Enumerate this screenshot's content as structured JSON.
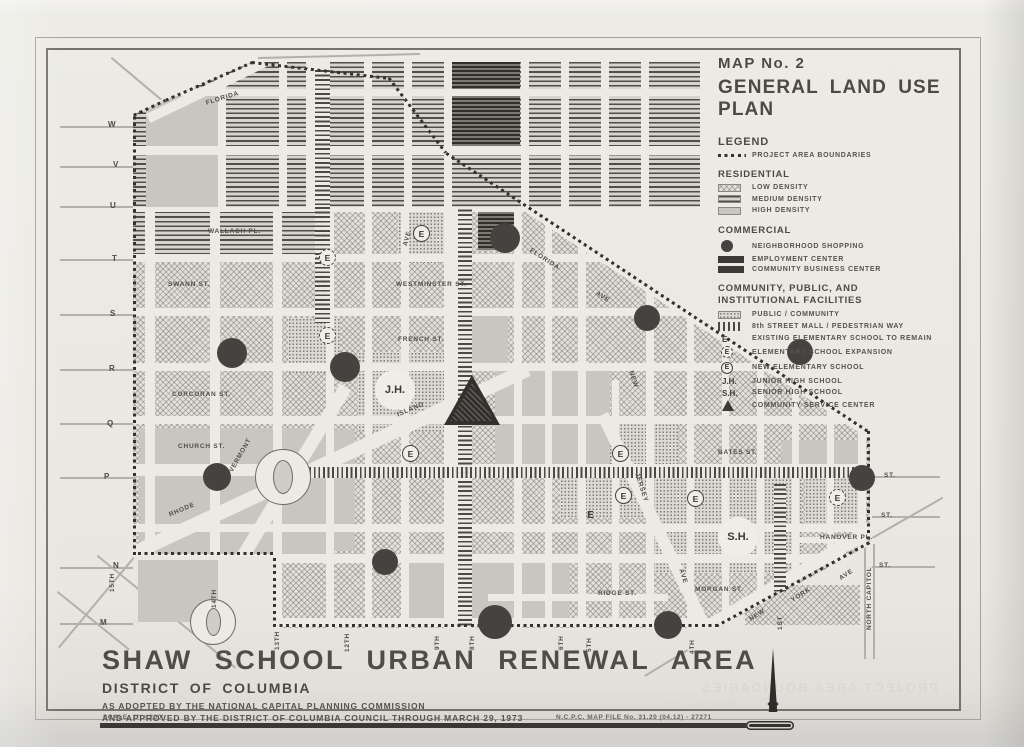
{
  "legend": {
    "map_no": "MAP No. 2",
    "title": "GENERAL LAND USE PLAN",
    "legend_label": "LEGEND",
    "boundary_label": "PROJECT AREA BOUNDARIES",
    "sections": [
      {
        "heading": "RESIDENTIAL",
        "rows": [
          {
            "sw": "low",
            "label": "LOW DENSITY"
          },
          {
            "sw": "med",
            "label": "MEDIUM DENSITY"
          },
          {
            "sw": "high",
            "label": "HIGH DENSITY"
          }
        ]
      },
      {
        "heading": "COMMERCIAL",
        "rows": [
          {
            "sw": "circ",
            "label": "NEIGHBORHOOD SHOPPING"
          },
          {
            "sw": "bar",
            "label": "EMPLOYMENT CENTER"
          },
          {
            "sw": "bar",
            "label": "COMMUNITY BUSINESS CENTER"
          }
        ]
      },
      {
        "heading": "COMMUNITY, PUBLIC, AND\nINSTITUTIONAL FACILITIES",
        "rows": [
          {
            "sw": "pub",
            "label": "PUBLIC / COMMUNITY"
          },
          {
            "sw": "mall",
            "label": "8th STREET MALL / PEDESTRIAN WAY"
          },
          {
            "sw": "E",
            "label": "EXISTING ELEMENTARY SCHOOL TO REMAIN"
          },
          {
            "sw": "Edash",
            "label": "ELEMENTARY SCHOOL EXPANSION"
          },
          {
            "sw": "Esolid",
            "label": "NEW ELEMENTARY SCHOOL"
          },
          {
            "sw": "JH",
            "label": "JUNIOR HIGH SCHOOL"
          },
          {
            "sw": "SH",
            "label": "SENIOR HIGH SCHOOL"
          },
          {
            "sw": "tri",
            "label": "COMMUNITY SERVICE CENTER"
          }
        ]
      }
    ],
    "symbol_text": {
      "E": "E",
      "JH": "J.H.",
      "SH": "S.H."
    }
  },
  "title_block": {
    "title": "SHAW SCHOOL URBAN RENEWAL AREA",
    "subtitle": "DISTRICT OF COLUMBIA",
    "line1": "AS ADOPTED BY THE NATIONAL CAPITAL PLANNING COMMISSION",
    "line2": "AND APPROVED BY THE DISTRICT OF COLUMBIA COUNCIL THROUGH MARCH 29, 1973",
    "scale": "SCALE: 1\" = 200'",
    "file_no": "N.C.P.C.  MAP FILE No.  31.20 (04.12) - 27271"
  },
  "ghosts": [
    {
      "t": "AREA",
      "x": 500,
      "y": 86,
      "s": 44,
      "ls": 10
    },
    {
      "t": "PROJECT  AREA  BOUNDARIES",
      "x": 700,
      "y": 680,
      "s": 13,
      "ls": 2
    },
    {
      "t": "MAP  No.  2",
      "x": 668,
      "y": 701,
      "s": 10,
      "ls": 2
    }
  ],
  "map": {
    "boundary_points": [
      [
        133,
        115
      ],
      [
        165,
        100
      ],
      [
        252,
        62
      ],
      [
        390,
        78
      ],
      [
        447,
        153
      ],
      [
        870,
        432
      ],
      [
        870,
        545
      ],
      [
        718,
        628
      ],
      [
        273,
        628
      ],
      [
        273,
        556
      ],
      [
        133,
        556
      ],
      [
        133,
        115
      ]
    ],
    "top_clip": [
      [
        133,
        115
      ],
      [
        165,
        100
      ],
      [
        252,
        62
      ],
      [
        700,
        62
      ],
      [
        700,
        207
      ],
      [
        133,
        207
      ]
    ],
    "main_clip": [
      [
        133,
        207
      ],
      [
        529,
        207
      ],
      [
        870,
        432
      ],
      [
        870,
        545
      ],
      [
        718,
        628
      ],
      [
        273,
        628
      ],
      [
        273,
        556
      ],
      [
        133,
        556
      ]
    ],
    "top_zone": {
      "rects": [
        [
          133,
          62,
          567,
          146,
          "pat-med"
        ],
        [
          146,
          95,
          76,
          112,
          "pat-high"
        ],
        [
          452,
          62,
          68,
          88,
          "pat-dark"
        ]
      ],
      "h_streets": [
        [
          92,
          150,
          700,
          7
        ],
        [
          150,
          133,
          700,
          9
        ]
      ],
      "v_streets": [
        [
          222,
          62,
          207,
          8
        ],
        [
          283,
          62,
          207,
          8
        ],
        [
          318,
          62,
          207,
          24
        ],
        [
          368,
          62,
          207,
          8
        ],
        [
          408,
          62,
          207,
          8
        ],
        [
          448,
          62,
          207,
          8
        ],
        [
          525,
          62,
          207,
          8
        ],
        [
          565,
          62,
          207,
          8
        ],
        [
          605,
          62,
          207,
          8
        ],
        [
          645,
          62,
          207,
          8
        ]
      ],
      "diag_streets": [
        [
          146,
          119,
          262,
          63,
          10
        ]
      ],
      "bands_v": [
        [
          322,
          70,
          137,
          15
        ]
      ]
    },
    "main_zone": {
      "rects": [
        [
          133,
          153,
          739,
          477,
          "pat-low"
        ],
        [
          133,
          207,
          182,
          52,
          "pat-med"
        ],
        [
          398,
          205,
          58,
          58,
          "pat-pub"
        ],
        [
          288,
          318,
          52,
          55,
          "pat-pub"
        ],
        [
          358,
          352,
          98,
          80,
          "pat-pub"
        ],
        [
          560,
          420,
          118,
          98,
          "pat-pub"
        ],
        [
          652,
          475,
          150,
          98,
          "pat-pub"
        ],
        [
          805,
          450,
          58,
          82,
          "pat-pub"
        ],
        [
          508,
          563,
          30,
          34,
          "pat-pub"
        ],
        [
          140,
          428,
          192,
          126,
          "pat-high"
        ],
        [
          213,
          532,
          118,
          26,
          "pat-high"
        ],
        [
          408,
          553,
          162,
          72,
          "pat-high"
        ],
        [
          495,
          368,
          115,
          100,
          "pat-high"
        ],
        [
          450,
          315,
          58,
          55,
          "pat-high"
        ],
        [
          782,
          440,
          80,
          30,
          "pat-high"
        ],
        [
          300,
          430,
          55,
          120,
          "pat-high"
        ],
        [
          478,
          210,
          44,
          40,
          "pat-dark"
        ]
      ],
      "h_streets": [
        [
          207,
          133,
          700,
          9
        ],
        [
          258,
          133,
          872,
          8
        ],
        [
          312,
          133,
          872,
          8
        ],
        [
          367,
          133,
          872,
          8
        ],
        [
          420,
          133,
          872,
          8
        ],
        [
          470,
          133,
          872,
          12
        ],
        [
          528,
          133,
          872,
          8
        ],
        [
          558,
          133,
          872,
          9
        ],
        [
          597,
          488,
          668,
          7
        ],
        [
          540,
          795,
          864,
          6
        ],
        [
          622,
          273,
          718,
          9
        ]
      ],
      "v_streets": [
        [
          150,
          207,
          556,
          10
        ],
        [
          215,
          207,
          628,
          10
        ],
        [
          277,
          207,
          628,
          9
        ],
        [
          330,
          207,
          628,
          8
        ],
        [
          368,
          207,
          628,
          7
        ],
        [
          405,
          207,
          628,
          8
        ],
        [
          448,
          207,
          628,
          8
        ],
        [
          460,
          207,
          628,
          24
        ],
        [
          518,
          207,
          628,
          8
        ],
        [
          548,
          207,
          628,
          7
        ],
        [
          582,
          207,
          628,
          8
        ],
        [
          615,
          380,
          628,
          7
        ],
        [
          650,
          207,
          628,
          8
        ],
        [
          690,
          207,
          628,
          7
        ],
        [
          725,
          207,
          628,
          7
        ],
        [
          760,
          350,
          628,
          7
        ],
        [
          795,
          350,
          628,
          7
        ],
        [
          830,
          350,
          628,
          7
        ],
        [
          862,
          400,
          628,
          8
        ]
      ],
      "diag_streets": [
        [
          126,
          556,
          525,
          370,
          14
        ],
        [
          194,
          630,
          340,
          390,
          13
        ],
        [
          608,
          418,
          710,
          630,
          12
        ],
        [
          884,
          536,
          688,
          652,
          13
        ],
        [
          438,
          146,
          880,
          438,
          11
        ]
      ],
      "bands_v": [
        [
          322,
          207,
          116,
          15
        ],
        [
          465,
          205,
          424,
          14
        ],
        [
          780,
          484,
          108,
          12
        ]
      ],
      "bands_h": [
        [
          300,
          472,
          562,
          11
        ]
      ]
    },
    "context_rects": [
      [
        138,
        560,
        80,
        62,
        "pat-high"
      ],
      [
        745,
        585,
        115,
        40,
        "pat-low"
      ]
    ],
    "context_lines": [
      [
        60,
        127,
        133,
        127
      ],
      [
        60,
        167,
        133,
        167
      ],
      [
        60,
        207,
        133,
        207
      ],
      [
        60,
        260,
        133,
        260
      ],
      [
        60,
        315,
        133,
        315
      ],
      [
        60,
        370,
        133,
        370
      ],
      [
        60,
        424,
        133,
        424
      ],
      [
        60,
        478,
        133,
        478
      ],
      [
        60,
        568,
        133,
        568
      ],
      [
        60,
        624,
        133,
        624
      ],
      [
        872,
        477,
        940,
        477
      ],
      [
        872,
        517,
        940,
        517
      ],
      [
        872,
        567,
        935,
        567
      ],
      [
        872,
        538,
        942,
        498
      ],
      [
        866,
        545,
        866,
        660
      ],
      [
        875,
        545,
        875,
        660
      ],
      [
        112,
        58,
        162,
        100
      ],
      [
        258,
        58,
        420,
        54
      ],
      [
        58,
        648,
        133,
        558
      ],
      [
        98,
        556,
        236,
        668
      ],
      [
        58,
        592,
        130,
        650
      ],
      [
        688,
        652,
        645,
        678
      ]
    ],
    "shopping_circles": [
      [
        505,
        238,
        15
      ],
      [
        647,
        318,
        13
      ],
      [
        800,
        352,
        13
      ],
      [
        862,
        478,
        13
      ],
      [
        232,
        353,
        15
      ],
      [
        345,
        367,
        15
      ],
      [
        217,
        477,
        14
      ],
      [
        385,
        562,
        13
      ],
      [
        495,
        622,
        17
      ],
      [
        668,
        625,
        14
      ]
    ],
    "schools": {
      "e_solid": [
        [
          421,
          233
        ],
        [
          410,
          453
        ],
        [
          620,
          453
        ],
        [
          623,
          495
        ],
        [
          695,
          498
        ]
      ],
      "e_dash": [
        [
          327,
          257
        ],
        [
          327,
          335
        ],
        [
          837,
          497
        ]
      ],
      "e_plain": [
        [
          590,
          515
        ]
      ],
      "big": [
        {
          "t": "J.H.",
          "x": 395,
          "y": 390
        },
        {
          "t": "S.H.",
          "x": 738,
          "y": 537
        }
      ],
      "triangle": {
        "x": 472,
        "y": 400,
        "w": 56,
        "h": 50
      }
    },
    "circles_parks": [
      {
        "name": "logan-circle",
        "x": 283,
        "y": 477,
        "d": 56,
        "leaf_w": 20,
        "leaf_h": 34
      },
      {
        "name": "thomas-circle",
        "x": 213,
        "y": 622,
        "d": 46,
        "leaf_w": 15,
        "leaf_h": 28
      }
    ],
    "street_labels": [
      [
        "FLORIDA",
        205,
        100,
        -17
      ],
      [
        "FLORIDA",
        532,
        247,
        33
      ],
      [
        "AVE",
        598,
        290,
        33
      ],
      [
        "SWANN ST.",
        168,
        281,
        0
      ],
      [
        "WALLACH PL.",
        208,
        228,
        0
      ],
      [
        "CORCORAN ST.",
        172,
        391,
        0
      ],
      [
        "CHURCH ST.",
        178,
        443,
        0
      ],
      [
        "WESTMINSTER ST.",
        396,
        281,
        0
      ],
      [
        "FRENCH ST.",
        398,
        336,
        0
      ],
      [
        "RHODE",
        168,
        512,
        -23
      ],
      [
        "ISLAND",
        396,
        412,
        -23
      ],
      [
        "VERMONT",
        228,
        470,
        -60
      ],
      [
        "AVE",
        402,
        245,
        -75
      ],
      [
        "NEW",
        634,
        370,
        72
      ],
      [
        "JERSEY",
        640,
        472,
        72
      ],
      [
        "AVE",
        684,
        568,
        72
      ],
      [
        "NEW",
        748,
        617,
        -33
      ],
      [
        "YORK",
        790,
        598,
        -33
      ],
      [
        "AVE",
        838,
        576,
        -33
      ],
      [
        "BATES ST.",
        718,
        449,
        0
      ],
      [
        "HANOVER PL.",
        820,
        534,
        0
      ],
      [
        "RIDGE ST.",
        598,
        590,
        0
      ],
      [
        "MORGAN ST.",
        695,
        586,
        0
      ],
      [
        "NORTH CAPITOL",
        866,
        630,
        -90
      ],
      [
        "15TH",
        109,
        592,
        -90
      ],
      [
        "14TH",
        211,
        608,
        -90
      ],
      [
        "13TH",
        274,
        650,
        -90
      ],
      [
        "12TH",
        344,
        652,
        -90
      ],
      [
        "9TH",
        434,
        650,
        -90
      ],
      [
        "8TH",
        469,
        650,
        -90
      ],
      [
        "6TH",
        558,
        650,
        -90
      ],
      [
        "5TH",
        586,
        652,
        -90
      ],
      [
        "4TH",
        689,
        654,
        -90
      ],
      [
        "1ST",
        777,
        630,
        -90
      ],
      [
        "ST.",
        884,
        472,
        0
      ],
      [
        "ST.",
        881,
        512,
        0
      ],
      [
        "ST.",
        879,
        562,
        0
      ]
    ],
    "edge_letters": [
      [
        "W",
        108,
        120
      ],
      [
        "V",
        113,
        160
      ],
      [
        "U",
        110,
        201
      ],
      [
        "T",
        112,
        254
      ],
      [
        "S",
        110,
        309
      ],
      [
        "R",
        109,
        364
      ],
      [
        "Q",
        107,
        419
      ],
      [
        "P",
        104,
        472
      ],
      [
        "N",
        113,
        561
      ],
      [
        "M",
        100,
        618
      ]
    ]
  }
}
